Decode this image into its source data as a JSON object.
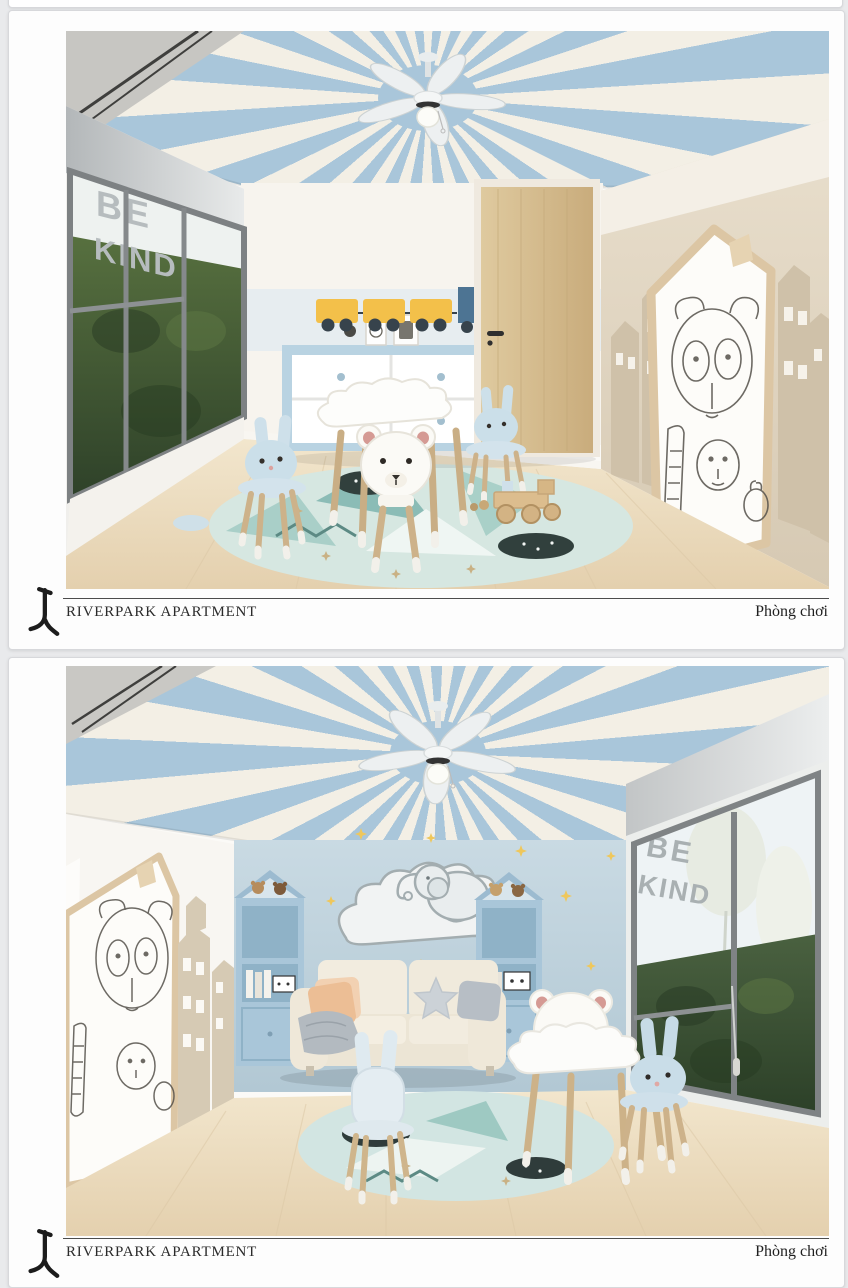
{
  "page": {
    "background_color": "#e9eaec",
    "width_px": 848,
    "height_px": 1280
  },
  "branding": {
    "logo_icon": "riverpark-calligraphic-mark"
  },
  "palette": {
    "ceiling_stripe_blue": "#a9c6da",
    "ceiling_stripe_cream": "#f3efe5",
    "nursery_wall_blue": "#c3d6e0",
    "furniture_blue": "#b9d3e2",
    "hedge_green": "#3c5334",
    "floor_wood": "#ead9bd",
    "rug_teal": "#8bbcb6",
    "toy_yellow": "#f3c04a",
    "toy_train_blue": "#4d7493",
    "caption_text": "#2b2b2b"
  },
  "panels": [
    {
      "caption": {
        "brand": "RIVERPARK APARTMENT",
        "room_label": "Phòng chơi"
      },
      "scene": {
        "window_decal": {
          "line1": "BE",
          "line2": "KIND"
        }
      }
    },
    {
      "caption": {
        "brand": "RIVERPARK APARTMENT",
        "room_label": "Phòng chơi"
      },
      "scene": {
        "window_decal": {
          "line1": "BE",
          "line2": "KIND"
        }
      }
    }
  ]
}
